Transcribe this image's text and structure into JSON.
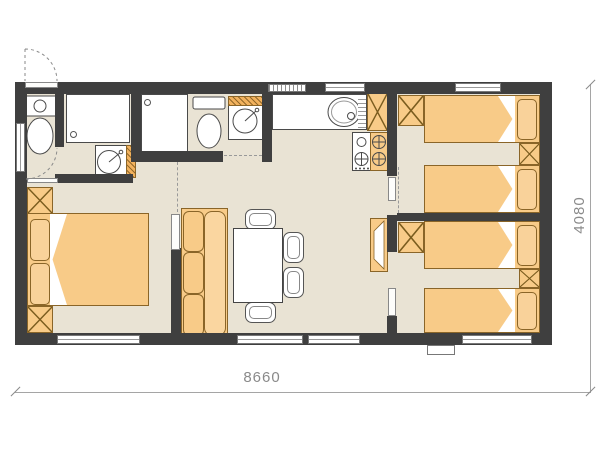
{
  "plan": {
    "type": "mobile-home-floor-plan",
    "width_label": "8660",
    "height_label": "4080",
    "rooms": [
      {
        "name": "bathroom-front",
        "fixtures": [
          "toilet",
          "shower-cabin",
          "washbasin-vanity"
        ]
      },
      {
        "name": "bathroom-middle",
        "fixtures": [
          "toilet",
          "shower-cabin",
          "washbasin-vanity"
        ]
      },
      {
        "name": "kitchen",
        "fixtures": [
          "counter",
          "sink-with-drainboard",
          "stove-4-burners",
          "tall-cabinet-fridge"
        ]
      },
      {
        "name": "living-room",
        "fixtures": [
          "sofa",
          "dining-table",
          "chair",
          "chair",
          "chair",
          "chair",
          "side-cabinet"
        ]
      },
      {
        "name": "master-bedroom",
        "fixtures": [
          "double-bed",
          "wardrobe",
          "wardrobe"
        ]
      },
      {
        "name": "bedroom-top-right",
        "fixtures": [
          "single-bed",
          "single-bed",
          "wardrobe",
          "nightstand"
        ]
      },
      {
        "name": "bedroom-bottom-right",
        "fixtures": [
          "single-bed",
          "single-bed",
          "wardrobe",
          "nightstand"
        ]
      }
    ],
    "openings": [
      "entry-door-swing",
      "interior-doors",
      "windows",
      "exterior-step"
    ]
  },
  "colors": {
    "wall": "#3f3f3f",
    "floor": "#e9e3d4",
    "furniture": "#f8cb88",
    "furniture_outline": "#8a6528",
    "fixture_outline": "#4a4a4a",
    "dimension_text": "#8a8a8a",
    "background": "#ffffff"
  }
}
